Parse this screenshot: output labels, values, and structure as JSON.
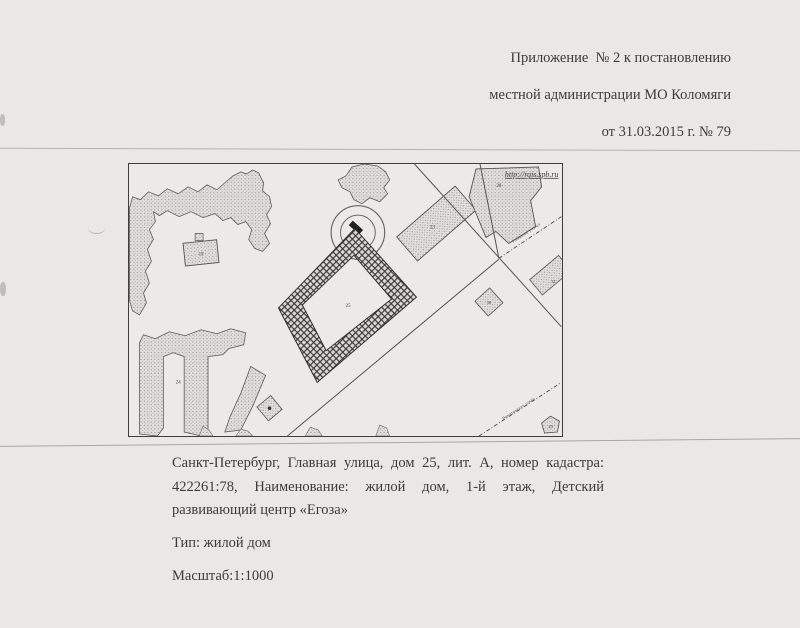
{
  "header": {
    "line1": "Приложение  № 2 к постановлению",
    "line2": "местной администрации МО Коломяги",
    "line3": "от 31.03.2015 г. № 79"
  },
  "caption": {
    "address": "Санкт-Петербург, Главная улица, дом 25, лит. А, номер кадастра: 422261:78, Наименование: жилой дом, 1-й этаж, Детский развивающий центр «Егоза»",
    "type_line": "Тип: жилой дом",
    "scale_line": "Масштаб:1:1000"
  },
  "map": {
    "watermark_url": "http://rgis.spb.ru",
    "street_labels": {
      "northeast": "Главная улица",
      "southeast": "Никитинская улица"
    },
    "building_labels": {
      "b19": "19",
      "b23": "23",
      "b24": "24",
      "b25": "25",
      "b28": "28",
      "b29": "29",
      "b30": "30",
      "b31": "31"
    }
  },
  "colors": {
    "paper": "#e9e8e6",
    "ink": "#3b3b3b",
    "map_ink": "#4a4a48"
  }
}
